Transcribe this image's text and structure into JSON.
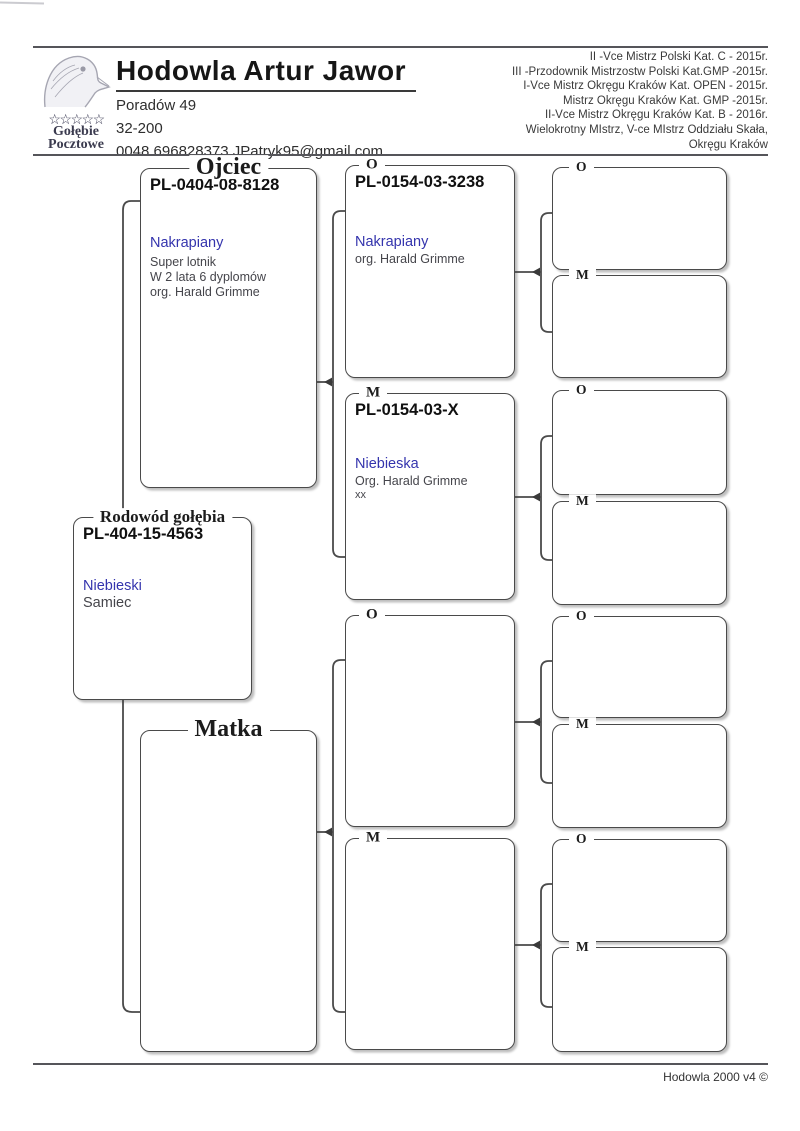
{
  "header": {
    "title": "Hodowla Artur Jawor",
    "address_line1": "Poradów 49",
    "address_line2": "32-200",
    "contact": "0048 696828373 JPatryk95@gmail.com",
    "logo": {
      "icon": "pigeon-head-icon",
      "stars": "☆☆☆☆☆",
      "name_line1": "Gołębie",
      "name_line2": "Pocztowe"
    },
    "achievements": [
      "II -Vce Mistrz Polski Kat. C - 2015r.",
      "III -Przodownik Mistrzostw Polski Kat.GMP -2015r.",
      "I-Vce Mistrz Okręgu Kraków Kat. OPEN - 2015r.",
      "Mistrz Okręgu Kraków Kat. GMP -2015r.",
      "II-Vce Mistrz Okręgu Kraków Kat. B - 2016r.",
      "Wielokrotny MIstrz, V-ce MIstrz  Oddziału Skała,",
      "Okręgu Kraków"
    ]
  },
  "pedigree": {
    "subject": {
      "legend": "Rodowód gołębia",
      "ring": "PL-404-15-4563",
      "color": "Niebieski",
      "detail1": "Samiec"
    },
    "father": {
      "legend": "Ojciec",
      "ring": "PL-0404-08-8128",
      "color": "Nakrapiany",
      "detail1": "Super lotnik",
      "detail2": "W 2 lata 6 dyplomów",
      "detail3": "org. Harald Grimme"
    },
    "mother": {
      "legend": "Matka"
    },
    "gen3": [
      {
        "legend": "O",
        "ring": "PL-0154-03-3238",
        "color": "Nakrapiany",
        "detail1": "org. Harald Grimme"
      },
      {
        "legend": "M",
        "ring": "PL-0154-03-X",
        "color": "Niebieska",
        "detail1": "Org. Harald Grimme",
        "detail2": "xx"
      },
      {
        "legend": "O"
      },
      {
        "legend": "M"
      }
    ],
    "gen4": [
      {
        "legend": "O"
      },
      {
        "legend": "M"
      },
      {
        "legend": "O"
      },
      {
        "legend": "M"
      },
      {
        "legend": "O"
      },
      {
        "legend": "M"
      },
      {
        "legend": "O"
      },
      {
        "legend": "M"
      }
    ]
  },
  "footer": {
    "text": "Hodowla 2000 v4 ©"
  },
  "colors": {
    "accent_blue": "#3434ad",
    "line": "#4a4a4a"
  }
}
